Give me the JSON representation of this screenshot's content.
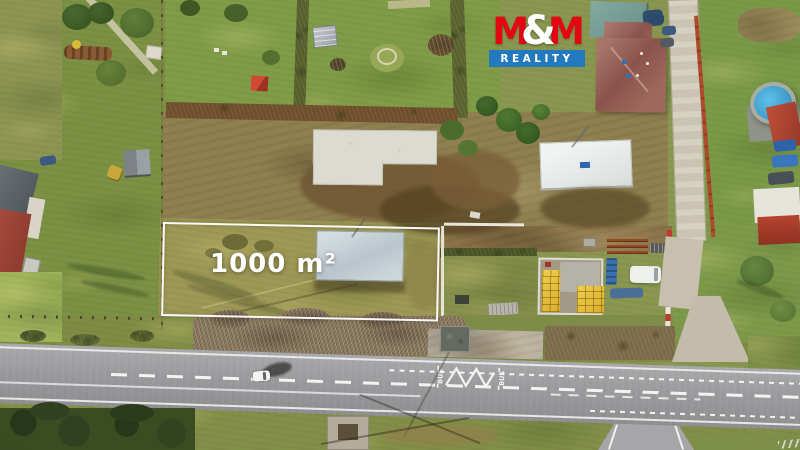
{
  "overlay": {
    "area_label": "1000 m²",
    "outline_color": "#ffffff",
    "label_color": "#ffffff"
  },
  "logo": {
    "m_first": "M",
    "ampersand": "&",
    "m_second": "M",
    "subtitle": "REALITY",
    "red": "#e30613",
    "blue": "#2279bd",
    "text_white": "#ffffff"
  },
  "road_markings": {
    "bus_left": "BUS",
    "bus_right": "BUS"
  },
  "palette": {
    "grass": "#7e9446",
    "meadow": "#9f9a58",
    "dirt": "#7b6038",
    "asphalt": "#9b9b9d",
    "marking_white": "#f2f4f4",
    "concrete_slab": "#dcdbd2",
    "roof_metal_gray": "#c5cfd4",
    "roof_house_red": "#96605a",
    "pool_blue": "#38a3d8",
    "pallets_yellow": "#e0bb35",
    "fence_red": "#b04a2c"
  }
}
